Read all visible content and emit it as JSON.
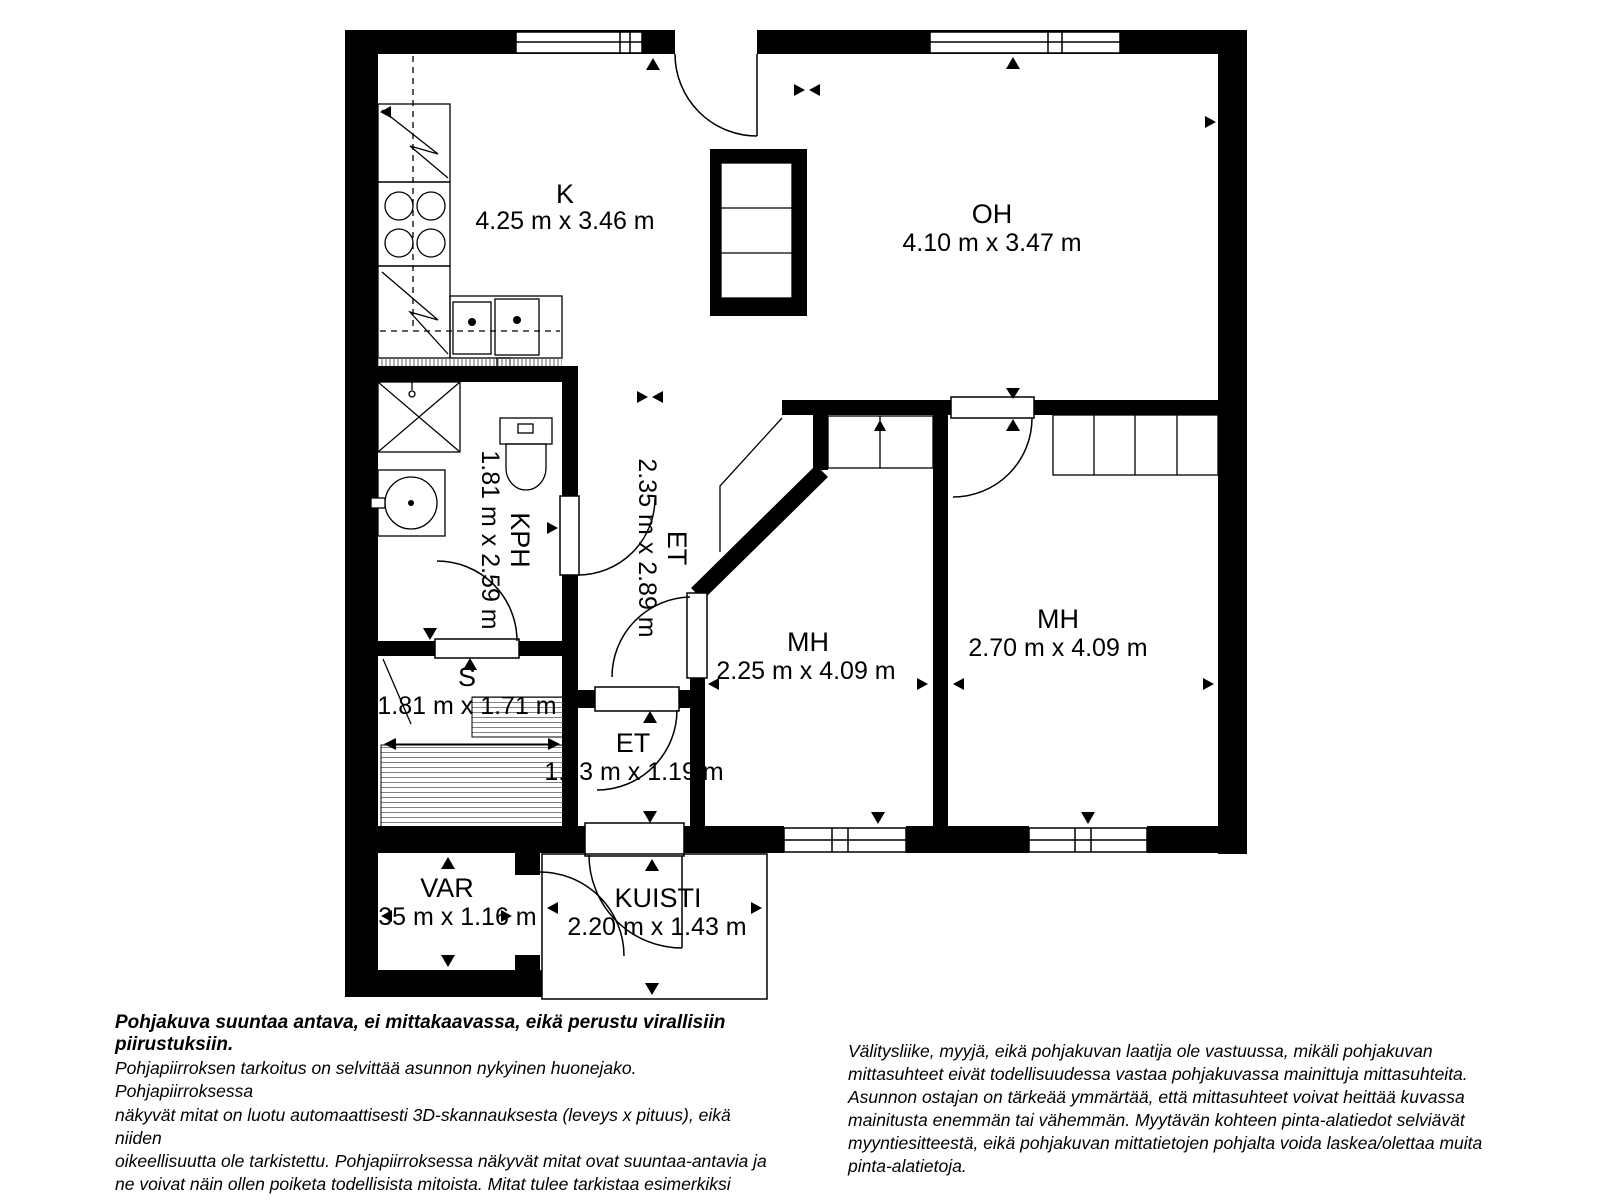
{
  "title": "Pohjakuva (floor plan)",
  "rooms": [
    {
      "label": "K",
      "dims": "4.25 m x 3.46 m"
    },
    {
      "label": "OH",
      "dims": "4.10 m x 3.47 m"
    },
    {
      "label": "KPH",
      "dims": "1.81 m x 2.59 m"
    },
    {
      "label": "ET",
      "dims": "2.35 m x 2.89 m"
    },
    {
      "label": "MH",
      "dims": "2.25 m x 4.09 m"
    },
    {
      "label": "MH",
      "dims": "2.70 m x 4.09 m"
    },
    {
      "label": "S",
      "dims": "1.81 m x 1.71 m"
    },
    {
      "label": "ET",
      "dims": "1.13 m x 1.19 m"
    },
    {
      "label": "VAR",
      "dims": "1.35 m x 1.16 m"
    },
    {
      "label": "KUISTI",
      "dims": "2.20 m x 1.43 m"
    }
  ],
  "notes": {
    "disclaimer": "Pohjakuva suuntaa antava, ei mittakaavassa, eikä perustu virallisiin piirustuksiin.",
    "left": "Pohjapiirroksen tarkoitus on selvittää asunnon nykyinen huonejako. Pohjapiirroksessa\nnäkyvät mitat on luotu automaattisesti 3D-skannauksesta (leveys x pituus), eikä niiden\noikeellisuutta ole tarkistettu. Pohjapiirroksessa näkyvät mitat ovat suuntaa-antavia ja\nne voivat näin ollen poiketa todellisista mitoista. Mitat tulee tarkistaa esimerkiksi\nremonttia suunniteltaessa. Mittauskohdat on merkitty kuvaan pienillä kolmioilla.",
    "right": "Välitysliike, myyjä, eikä pohjakuvan laatija ole vastuussa, mikäli pohjakuvan\nmittasuhteet eivät todellisuudessa vastaa pohjakuvassa mainittuja mittasuhteita.\nAsunnon ostajan on tärkeää ymmärtää, että mittasuhteet voivat heittää kuvassa\nmainitusta enemmän tai vähemmän. Myytävän kohteen pinta-alatiedot selviävät\nmyyntiesitteestä, eikä pohjakuvan mittatietojen pohjalta voida laskea/olettaa muita\npinta-alatietoja."
  },
  "colors": {
    "wall": "#000000",
    "background": "#ffffff",
    "bench_hatch": "#808080"
  }
}
